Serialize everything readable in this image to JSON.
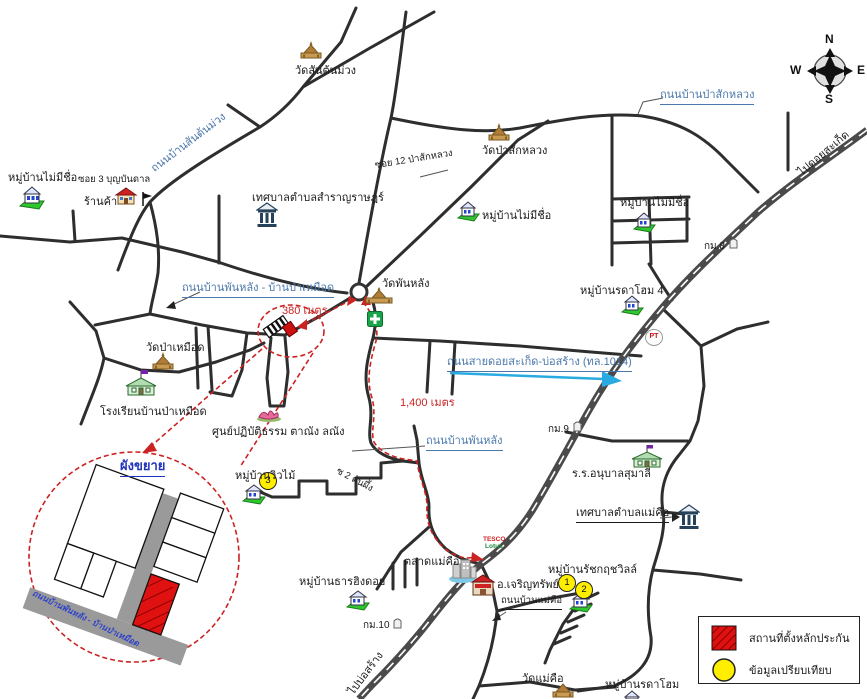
{
  "colors": {
    "road_label_blue": "#4a78aa",
    "route_red": "#cc2222",
    "highway_gray": "#4a4a4a",
    "site_red": "#dd1111",
    "comparison_yellow": "#ffee00",
    "hwy1014_arrow_cyan": "#29abe2"
  },
  "compass": {
    "north": "N",
    "south": "S",
    "east": "E",
    "west": "W"
  },
  "legend": {
    "site": "สถานที่ตั้งหลักประกัน",
    "comparison": "ข้อมูลเปรียบเทียบ"
  },
  "inset": {
    "title": "ผังขยาย",
    "road": "ถนนบ้านพันหลัง - บ้านป่าเหมือด"
  },
  "roads": {
    "santonmuang": "ถนนบ้านสันต้นม่วง",
    "pasakluang": "ถนนบ้านป่าสักหลวง",
    "phanlang_pamuead": "ถนนบ้านพันหลัง - บ้านป่าเหมือด",
    "doisaket_bosang": "ถนนสายดอยสะเก็ด-บ่อสร้าง (ทล.1014)",
    "phanlang": "ถนนบ้านพันหลัง",
    "maekhue": "ถนนบ้านแม่คือ"
  },
  "sois": {
    "soi3": "ซอย 3 บุญบันดาล",
    "soi12": "ซอย 12 ป่าสักหลวง",
    "soi2": "ซ 2 ต้นผึ้ง"
  },
  "directions": {
    "to_doisaket": "ไปดอยสะเก็ด",
    "to_bosang": "ไปบ่อสร้าง"
  },
  "distances": {
    "d380": "380 เมตร",
    "d1400": "1,400 เมตร"
  },
  "km": {
    "km8": "กม.8",
    "km9": "กม.9",
    "km10": "กม.10"
  },
  "places": {
    "village_no_name_1": "หมู่บ้านไม่มีชื่อ",
    "shop": "ร้านค้า",
    "wat_santonmuang": "วัดสันต้นม่วง",
    "wat_pasakluang": "วัดป่าสักหลวง",
    "tessaban_samranrat": "เทศบาลตำบลสำราญราษฎร์",
    "village_no_name_2": "หมู่บ้านไม่มีชื่อ",
    "village_no_name_3": "หมู่บ้านไม่มีชื่อ",
    "village_radahome4": "หมู่บ้านรดาโฮม 4",
    "wat_phanlang": "วัดพันหลัง",
    "wat_pamuead": "วัดป่าเหมือด",
    "school_pamuead": "โรงเรียนบ้านป่าเหมือด",
    "meditation": "ศูนย์ปฏิบัติธรรม ตาณัง ลณัง",
    "village_viewmai": "หมู่บ้านวิวไม้",
    "market_maekhue": "ตลาดแม่คือ",
    "charoensap": "อ.เจริญทรัพย์",
    "village_ratchakrit": "หมู่บ้านรัชกฤชวิลล์",
    "village_tharnhingdoi": "หมู่บ้านธารฮิงดอย",
    "school_sumalee": "ร.ร.อนุบาลสุมาลี",
    "tessaban_maekhue": "เทศบาลตำบลแม่คือ",
    "wat_maekhue": "วัดแม่คือ",
    "village_radahome": "หมู่บ้านรดาโฮม"
  },
  "badges": {
    "b1": "1",
    "b2": "2",
    "b3": "3"
  },
  "brands": {
    "pt": "PT",
    "tesco": "TESCO",
    "lotus": "Lotus"
  }
}
